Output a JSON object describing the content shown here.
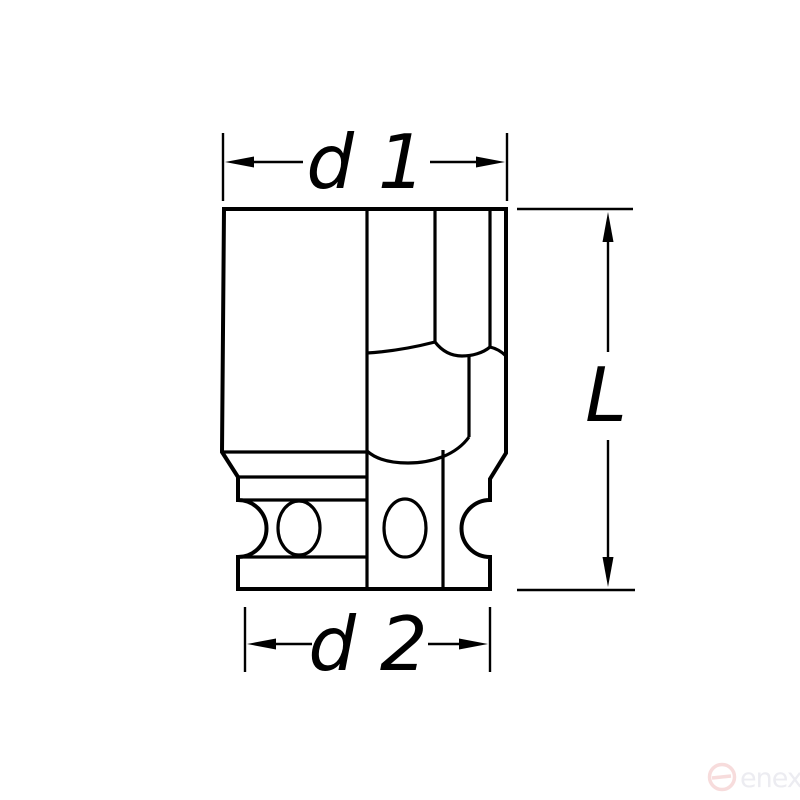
{
  "dimensions": {
    "d1": {
      "label": "d 1"
    },
    "d2": {
      "label": "d 2"
    },
    "length": {
      "label": "L"
    }
  },
  "watermark": {
    "brand": "enex"
  },
  "colors": {
    "line": "#000000",
    "background": "#ffffff",
    "watermark_logo": "#f7dcdc",
    "watermark_text": "#ececf1"
  }
}
